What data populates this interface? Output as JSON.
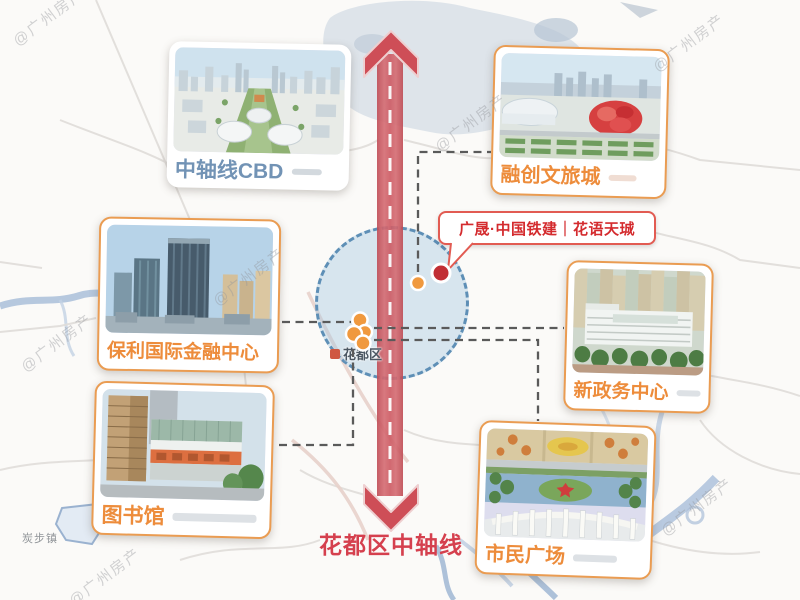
{
  "map": {
    "watermark_text": "@广州房产",
    "district_label": "花都区",
    "town_label": "炭步镇"
  },
  "axis": {
    "label": "花都区中轴线"
  },
  "project_badge": {
    "label": "广晟·中国铁建｜花语天珹"
  },
  "landmarks": [
    {
      "label": "中轴线CBD",
      "card_style": "white",
      "position": "top-left"
    },
    {
      "label": "融创文旅城",
      "card_style": "orange",
      "position": "top-right"
    },
    {
      "label": "保利国际金融中心",
      "card_style": "orange",
      "position": "mid-left"
    },
    {
      "label": "新政务中心",
      "card_style": "orange",
      "position": "mid-right"
    },
    {
      "label": "图书馆",
      "card_style": "orange",
      "position": "bottom-left"
    },
    {
      "label": "市民广场",
      "card_style": "orange",
      "position": "bottom-right"
    }
  ],
  "markers": {
    "project_dot": "花语天珹项目位置",
    "poi_dots": "花都区配套位置"
  },
  "colors": {
    "label_blue": "#7293B5",
    "label_orange": "#ED8C3B",
    "card_border_orange": "#EA9C52",
    "axis_band_red": "#CE5560",
    "axis_label_red": "#D5404E",
    "badge_text_red": "#D42B2E",
    "badge_border_red": "#E25B52",
    "project_dot_red": "#C12E34",
    "poi_dot_orange": "#F0993E",
    "district_circle_blue": "#5E8FB6",
    "connector_gray": "#5A5A5A"
  }
}
